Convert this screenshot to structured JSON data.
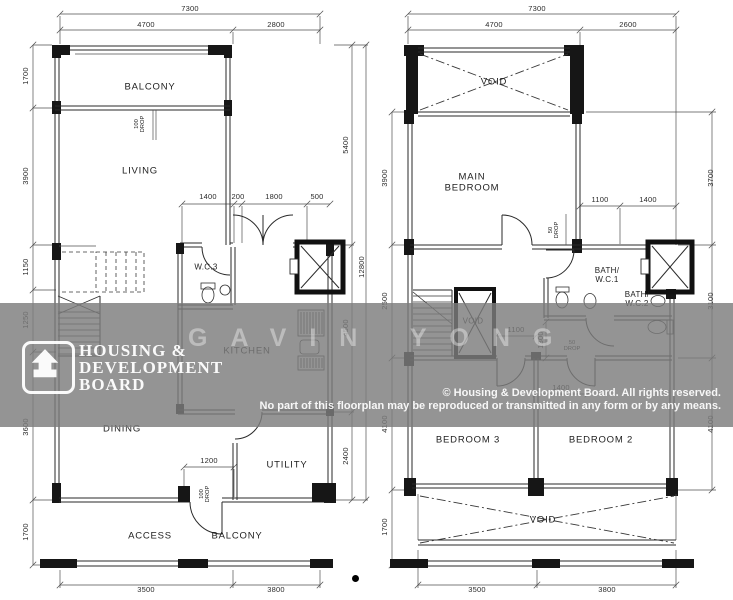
{
  "watermark": {
    "logo_line1": "HOUSING &",
    "logo_line2": "DEVELOPMENT",
    "logo_line3": "BOARD",
    "copyright_line1": "© Housing & Development Board. All rights reserved.",
    "copyright_line2": "No part of this floorplan may be reproduced or transmitted in any form or by any means.",
    "ghost_text": "GAVIN YONG",
    "band_color": "#949494"
  },
  "lower_floor": {
    "rooms": {
      "balcony_top": "BALCONY",
      "living": "LIVING",
      "wc3": "W.C.3",
      "kitchen": "KITCHEN",
      "dining": "DINING",
      "utility": "UTILITY",
      "access": "ACCESS",
      "balcony_bottom": "BALCONY"
    },
    "dims": {
      "top_total": "7300",
      "top_left": "4700",
      "top_right": "2800",
      "left_1": "1700",
      "left_2": "3900",
      "left_3": "1150",
      "left_4": "1250",
      "left_5": "3600",
      "left_6": "1700",
      "right_1": "5400",
      "right_2": "4500",
      "right_3": "2400",
      "right_total": "12800",
      "kitchen_1": "1400",
      "kitchen_2": "200",
      "kitchen_3": "1800",
      "kitchen_4": "500",
      "utility_door": "1200",
      "bottom_1": "3500",
      "bottom_2": "3800",
      "drop_living": "100\nDROP",
      "drop_access": "100\nDROP"
    }
  },
  "upper_floor": {
    "rooms": {
      "void_top": "VOID",
      "main_bedroom": "MAIN\nBEDROOM",
      "bath_wc1": "BATH/\nW.C.1",
      "bath_wc2": "BATH/\nW.C.2",
      "stair_void": "VOID",
      "bedroom3": "BEDROOM 3",
      "bedroom2": "BEDROOM 2",
      "void_bottom": "VOID"
    },
    "dims": {
      "top_total": "7300",
      "top_left": "4700",
      "top_right": "2600",
      "left_1": "3900",
      "left_2": "2500",
      "left_3": "4100",
      "left_4": "1700",
      "right_1": "3700",
      "right_2": "3100",
      "right_3": "4100",
      "bath_1": "1100",
      "bath_2": "1400",
      "hall_1": "1100",
      "hall_2": "1300",
      "hall_3": "1400",
      "bottom_1": "3500",
      "bottom_2": "3800",
      "drop_bedroom": "50\nDROP",
      "drop_hall": "50\nDROP"
    }
  }
}
